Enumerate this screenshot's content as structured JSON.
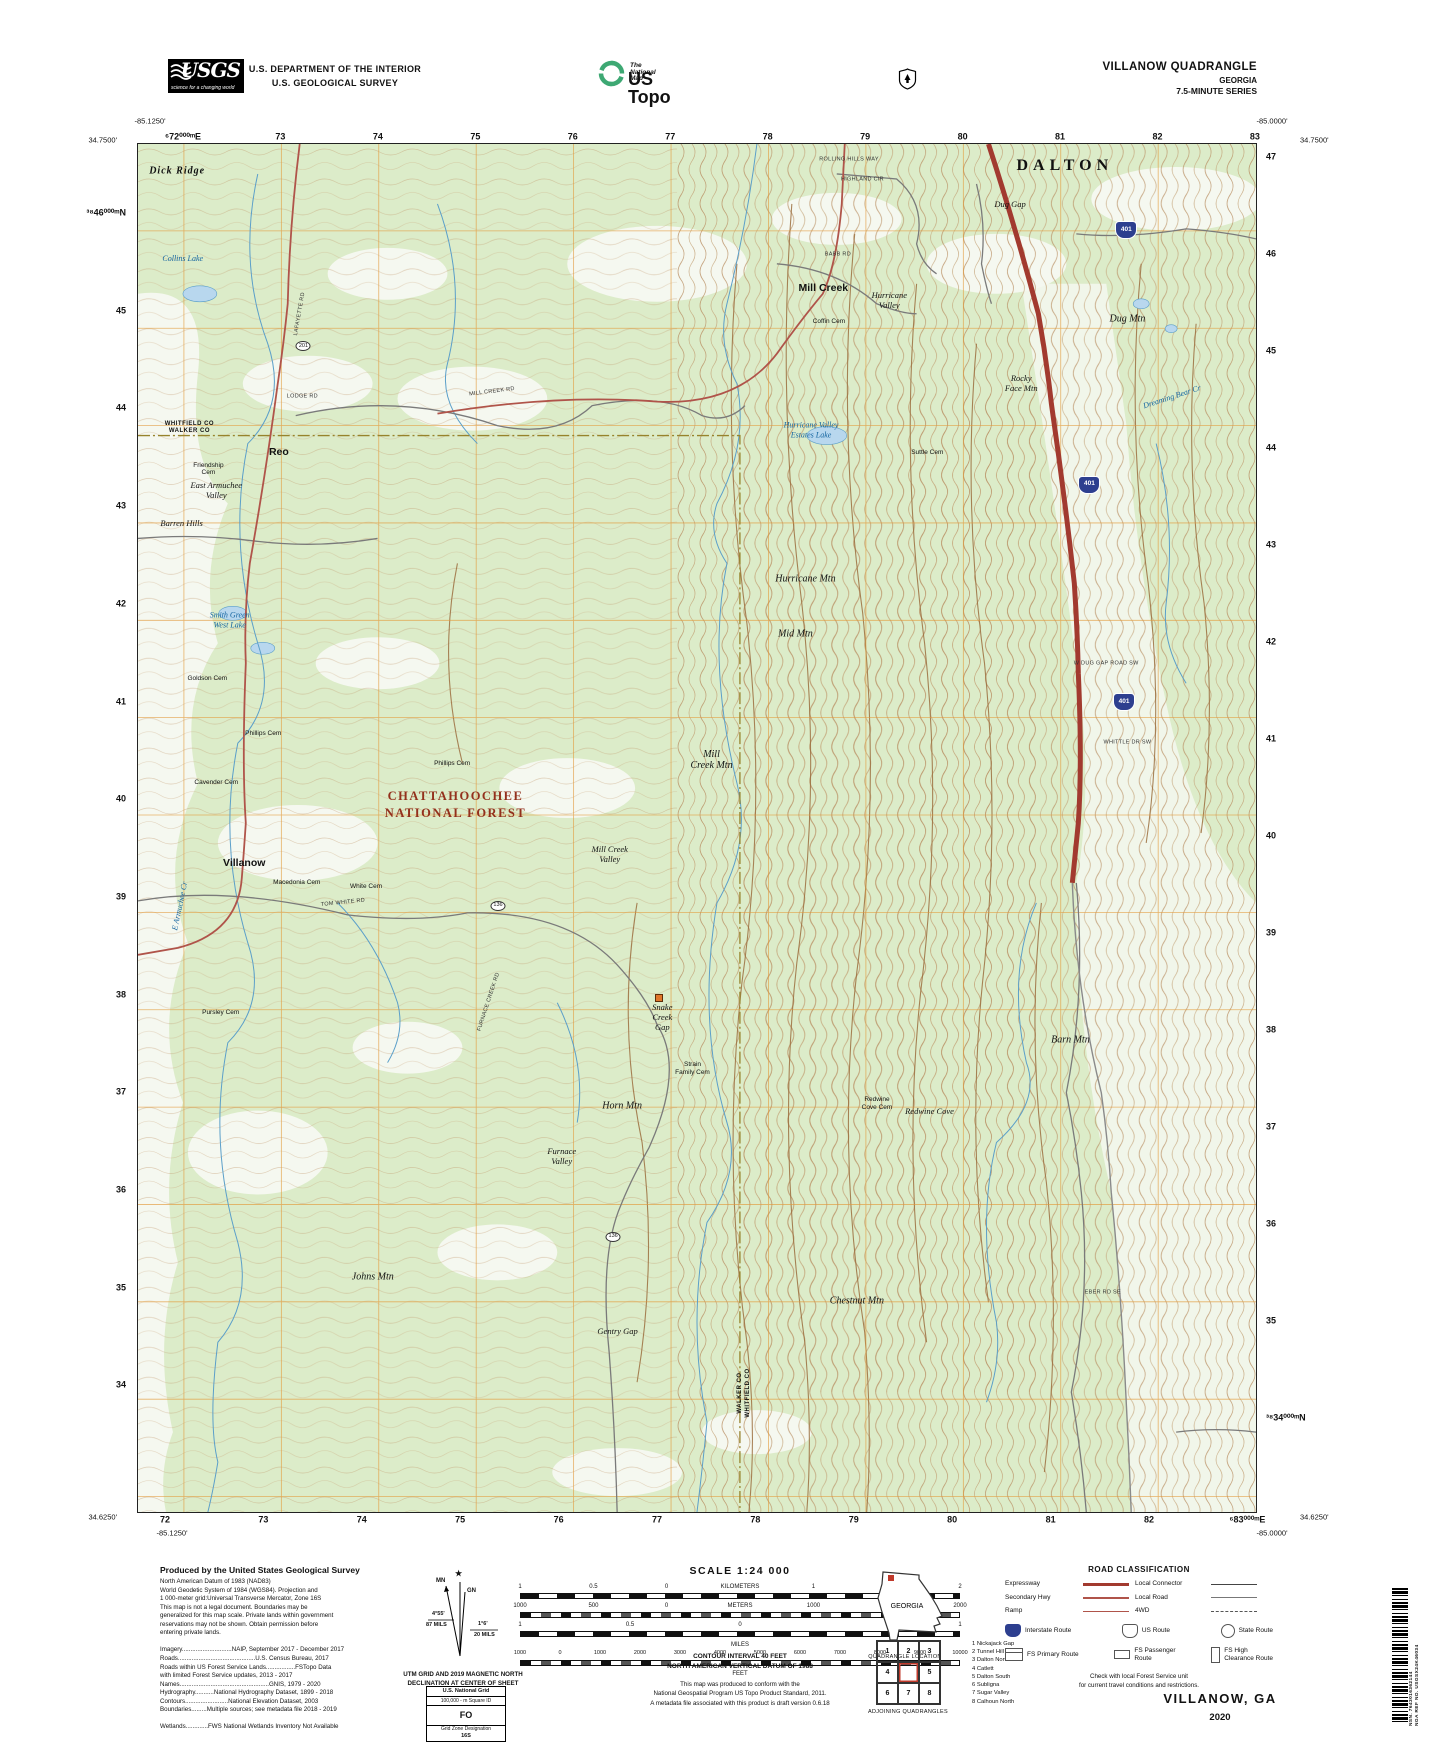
{
  "colors": {
    "map_green": "#dcecc9",
    "contour_brown": "#b98f63",
    "index_contour": "#9c6f3f",
    "water_blue": "#5b9fc9",
    "lake_fill": "#b8d7ee",
    "interstate_red": "#a23a2f",
    "secondary_red": "#b0544a",
    "grid_orange": "#e39a3b",
    "county_olive": "#97832c",
    "shield_blue": "#2d3f8f",
    "forest_label_red": "#93301c",
    "ustopo_green": "#3da873"
  },
  "header": {
    "usgs_wordmark": "USGS",
    "usgs_tagline": "science for a changing world",
    "dept_line1": "U.S. DEPARTMENT OF THE INTERIOR",
    "dept_line2": "U.S. GEOLOGICAL SURVEY",
    "ustopo_small": "The National Map",
    "ustopo_large": "US Topo",
    "quad_title": "VILLANOW QUADRANGLE",
    "quad_state": "GEORGIA",
    "quad_series": "7.5-MINUTE SERIES"
  },
  "map": {
    "corners": {
      "top_left_lon": "-85.1250'",
      "top_left_lat": "34.7500'",
      "top_right_lon": "-85.0000'",
      "top_right_lat": "34.7500'",
      "bottom_left_lat": "34.6250'",
      "bottom_left_lon": "-85.1250'",
      "bottom_right_lat": "34.6250'",
      "bottom_right_lon": "-85.0000'"
    },
    "grid": {
      "top": [
        "⁶72⁰⁰⁰ᵐE",
        "73",
        "74",
        "75",
        "76",
        "77",
        "78",
        "79",
        "80",
        "81",
        "82",
        "83"
      ],
      "bottom": [
        "72",
        "73",
        "74",
        "75",
        "76",
        "77",
        "78",
        "79",
        "80",
        "81",
        "82",
        "⁶83⁰⁰⁰ᵐE"
      ],
      "left": [
        "³⁸46⁰⁰⁰ᵐN",
        "45",
        "44",
        "43",
        "42",
        "41",
        "40",
        "39",
        "38",
        "37",
        "36",
        "35",
        "34"
      ],
      "right": [
        "47",
        "46",
        "45",
        "44",
        "43",
        "42",
        "41",
        "40",
        "39",
        "38",
        "37",
        "36",
        "35",
        "³⁸34⁰⁰⁰ᵐN"
      ]
    },
    "labels": [
      {
        "t": "Dick Ridge",
        "x": 3.5,
        "y": 2.0,
        "c": "c-ridge"
      },
      {
        "t": "DALTON",
        "x": 82.9,
        "y": 1.6,
        "c": "c-city"
      },
      {
        "t": "Mill Creek",
        "x": 61.3,
        "y": 10.6,
        "c": "c-town"
      },
      {
        "t": "Hurricane\nValley",
        "x": 67.2,
        "y": 11.4,
        "c": "c-terr2"
      },
      {
        "t": "Dug Gap",
        "x": 78.0,
        "y": 4.4,
        "c": "c-terr2"
      },
      {
        "t": "Dug Mtn",
        "x": 88.5,
        "y": 12.8,
        "c": "c-terr"
      },
      {
        "t": "Rocky\nFace Mtn",
        "x": 79.0,
        "y": 17.5,
        "c": "c-terr2"
      },
      {
        "t": "Suttle Cem",
        "x": 70.6,
        "y": 22.6,
        "c": "c-cem"
      },
      {
        "t": "WHITFIELD CO\nWALKER CO",
        "x": 4.6,
        "y": 20.8,
        "c": "c-county"
      },
      {
        "t": "Reo",
        "x": 12.6,
        "y": 22.6,
        "c": "c-town"
      },
      {
        "t": "Friendship\nCem",
        "x": 6.3,
        "y": 23.8,
        "c": "c-cem"
      },
      {
        "t": "East Armuchee\nValley",
        "x": 7.0,
        "y": 25.3,
        "c": "c-terr2"
      },
      {
        "t": "Barren Hills",
        "x": 3.9,
        "y": 27.7,
        "c": "c-terr2"
      },
      {
        "t": "Hurricane Mtn",
        "x": 59.7,
        "y": 31.8,
        "c": "c-terr"
      },
      {
        "t": "Mid Mtn",
        "x": 58.8,
        "y": 35.8,
        "c": "c-terr"
      },
      {
        "t": "Goldson Cem",
        "x": 6.2,
        "y": 39.1,
        "c": "c-cem"
      },
      {
        "t": "Phillips Cem",
        "x": 11.2,
        "y": 43.1,
        "c": "c-cem"
      },
      {
        "t": "Cavender Cem",
        "x": 7.0,
        "y": 46.7,
        "c": "c-cem"
      },
      {
        "t": "Phillips Cem",
        "x": 28.1,
        "y": 45.3,
        "c": "c-cem"
      },
      {
        "t": "CHATTAHOOCHEE\nNATIONAL FOREST",
        "x": 28.4,
        "y": 48.3,
        "c": "c-nf"
      },
      {
        "t": "Mill\nCreek Mtn",
        "x": 51.3,
        "y": 45.0,
        "c": "c-terr"
      },
      {
        "t": "Villanow",
        "x": 9.5,
        "y": 52.6,
        "c": "c-town"
      },
      {
        "t": "Macedonia Cem",
        "x": 14.2,
        "y": 54.0,
        "c": "c-cem"
      },
      {
        "t": "White Cem",
        "x": 20.4,
        "y": 54.3,
        "c": "c-cem"
      },
      {
        "t": "Mill Creek\nValley",
        "x": 42.2,
        "y": 51.9,
        "c": "c-terr2"
      },
      {
        "t": "TOM WHITE RD",
        "x": 18.3,
        "y": 55.5,
        "c": "c-road",
        "r": -6
      },
      {
        "t": "Pursley Cem",
        "x": 7.4,
        "y": 63.5,
        "c": "c-cem"
      },
      {
        "t": "Snake\nCreek\nGap",
        "x": 46.9,
        "y": 63.8,
        "c": "c-terr2"
      },
      {
        "t": "",
        "x": 46.6,
        "y": 62.4,
        "c": "c-marker"
      },
      {
        "t": "Strain\nFamily Cem",
        "x": 49.6,
        "y": 67.6,
        "c": "c-cem"
      },
      {
        "t": "Horn Mtn",
        "x": 43.3,
        "y": 70.3,
        "c": "c-terr"
      },
      {
        "t": "Redwine\nCove Cem",
        "x": 66.1,
        "y": 70.2,
        "c": "c-cem"
      },
      {
        "t": "Redwine Cove",
        "x": 70.8,
        "y": 70.7,
        "c": "c-terr2"
      },
      {
        "t": "Barn Mtn",
        "x": 83.4,
        "y": 65.5,
        "c": "c-terr"
      },
      {
        "t": "Furnace\nValley",
        "x": 37.9,
        "y": 74.0,
        "c": "c-terr2"
      },
      {
        "t": "Johns Mtn",
        "x": 21.0,
        "y": 82.8,
        "c": "c-terr"
      },
      {
        "t": "Gentry Gap",
        "x": 42.9,
        "y": 86.8,
        "c": "c-terr2"
      },
      {
        "t": "Chestnut Mtn",
        "x": 64.3,
        "y": 84.6,
        "c": "c-terr"
      },
      {
        "t": "WALKER CO\nWHITFIELD CO",
        "x": 54.3,
        "y": 91.3,
        "c": "c-county",
        "r": -90
      },
      {
        "t": "LAFAYETTE RD",
        "x": 14.5,
        "y": 12.4,
        "c": "c-road",
        "r": -80
      },
      {
        "t": "MILL CREEK RD",
        "x": 31.7,
        "y": 18.1,
        "c": "c-road",
        "r": -7
      },
      {
        "t": "LODGE RD",
        "x": 14.7,
        "y": 18.5,
        "c": "c-road"
      },
      {
        "t": "BABB RD",
        "x": 62.6,
        "y": 8.1,
        "c": "c-road"
      },
      {
        "t": "ROLLING HILLS WAY",
        "x": 63.6,
        "y": 1.2,
        "c": "c-road"
      },
      {
        "t": "HIGHLAND CIR",
        "x": 64.8,
        "y": 2.6,
        "c": "c-road"
      },
      {
        "t": "W DUG GAP ROAD SW",
        "x": 86.6,
        "y": 38.0,
        "c": "c-road"
      },
      {
        "t": "WHITTLE DR SW",
        "x": 88.5,
        "y": 43.8,
        "c": "c-road"
      },
      {
        "t": "EBER RD SE",
        "x": 86.3,
        "y": 84.0,
        "c": "c-road"
      },
      {
        "t": "FURNACE CREEK RD",
        "x": 31.4,
        "y": 62.7,
        "c": "c-road",
        "r": -72
      },
      {
        "t": "Coffin Cem",
        "x": 61.8,
        "y": 13.0,
        "c": "c-cem"
      },
      {
        "t": "E Armuchee Cr",
        "x": 3.8,
        "y": 55.7,
        "c": "c-water",
        "r": -78
      },
      {
        "t": "Dreaming Bear Cr",
        "x": 92.5,
        "y": 18.5,
        "c": "c-water",
        "r": -18
      },
      {
        "t": "Collins Lake",
        "x": 4.0,
        "y": 8.4,
        "c": "c-water"
      },
      {
        "t": "Smith Green\nWest Lake",
        "x": 8.2,
        "y": 34.8,
        "c": "c-water"
      },
      {
        "t": "Hurricane Valley\nEstates Lake",
        "x": 60.2,
        "y": 20.9,
        "c": "c-water"
      }
    ],
    "shields": [
      {
        "n": "401",
        "x": 88.4,
        "y": 6.3
      },
      {
        "n": "401",
        "x": 85.1,
        "y": 24.9
      },
      {
        "n": "401",
        "x": 88.2,
        "y": 40.8
      }
    ],
    "route_ovals": [
      {
        "n": "201",
        "x": 14.8,
        "y": 14.8
      },
      {
        "n": "136",
        "x": 32.2,
        "y": 55.7
      },
      {
        "n": "136",
        "x": 42.5,
        "y": 79.9
      }
    ]
  },
  "footer": {
    "credits_title": "Produced by the United States Geological Survey",
    "credits_lines": [
      "North American Datum of 1983 (NAD83)",
      "World Geodetic System of 1984 (WGS84).  Projection and",
      "1 000-meter grid:Universal Transverse Mercator, Zone 16S",
      "This map is not a legal document. Boundaries may be",
      "generalized for this map scale. Private lands within government",
      "reservations may not be shown. Obtain permission before",
      "entering private lands.",
      "",
      "Imagery.............................NAIP, September 2017 - December 2017",
      "Roads.............................................U.S. Census Bureau, 2017",
      "Roads within US Forest Service Lands.................FSTopo Data",
      "            with limited Forest Service updates, 2013 - 2017",
      "Names....................................................GNIS, 1979 - 2020",
      "Hydrography...........National Hydrography Dataset, 1899 - 2018",
      "Contours.........................National Elevation Dataset, 2003",
      "Boundaries.........Multiple sources; see metadata file 2018 - 2019",
      "",
      "Wetlands.............FWS National Wetlands Inventory Not Available"
    ],
    "declination": {
      "star": "★",
      "mn": "MN",
      "gn": "GN",
      "mn_deg": "4°55'",
      "mn_mils": "87 MILS",
      "gn_deg": "1°6'",
      "gn_mils": "20 MILS",
      "caption1": "UTM GRID AND 2019 MAGNETIC NORTH",
      "caption2": "DECLINATION AT CENTER OF SHEET"
    },
    "usng": {
      "title": "U.S. National Grid",
      "sub": "100,000 - m Square ID",
      "square": "FO",
      "zone_label": "Grid Zone Designation",
      "zone": "16S"
    },
    "scale": {
      "title": "SCALE 1:24 000",
      "km_labels": [
        "1",
        "0.5",
        "0",
        "KILOMETERS",
        "1",
        "2"
      ],
      "m_labels": [
        "1000",
        "500",
        "0",
        "METERS",
        "1000",
        "2000"
      ],
      "mi_labels": [
        "1",
        "0.5",
        "0",
        "1"
      ],
      "mi_word": "MILES",
      "ft_labels": [
        "1000",
        "0",
        "1000",
        "2000",
        "3000",
        "4000",
        "5000",
        "6000",
        "7000",
        "8000",
        "9000",
        "10000"
      ],
      "ft_word": "FEET"
    },
    "contour_note1": "CONTOUR INTERVAL 40 FEET",
    "contour_note2": "NORTH AMERICAN VERTICAL DATUM OF 1988",
    "conform_lines": [
      "This map was produced to conform with the",
      "National Geospatial Program US Topo Product Standard, 2011.",
      "A metadata file associated with this product is draft version 0.6.18"
    ],
    "location": {
      "state": "GEORGIA",
      "caption": "QUADRANGLE LOCATION"
    },
    "adjoining": {
      "caption": "ADJOINING QUADRANGLES",
      "cells": [
        "1",
        "2",
        "3",
        "4",
        "",
        "5",
        "6",
        "7",
        "8"
      ],
      "list": [
        "1 Nickajack Gap",
        "2 Tunnel Hill",
        "3 Dalton North",
        "4 Catlett",
        "5 Dalton South",
        "6 Subligna",
        "7 Sugar Valley",
        "8 Calhoun North"
      ]
    },
    "roadclass": {
      "title": "ROAD CLASSIFICATION",
      "rows": [
        {
          "label": "Expressway",
          "style": "expressway"
        },
        {
          "label": "Secondary Hwy",
          "style": "secondary"
        },
        {
          "label": "Ramp",
          "style": "ramp"
        },
        {
          "label": "Local Connector",
          "style": "connector"
        },
        {
          "label": "Local Road",
          "style": "local"
        },
        {
          "label": "4WD",
          "style": "fourwd"
        }
      ],
      "shields": [
        {
          "label": "Interstate Route",
          "type": "interstate"
        },
        {
          "label": "US Route",
          "type": "us"
        },
        {
          "label": "State Route",
          "type": "state"
        }
      ],
      "fs": [
        {
          "label": "FS Primary Route",
          "type": "fsp"
        },
        {
          "label": "FS Passenger\nRoute",
          "type": "fspass"
        },
        {
          "label": "FS High\nClearance Route",
          "type": "fshigh"
        }
      ],
      "note1": "Check with local Forest Service unit",
      "note2": "for current travel conditions and restrictions."
    },
    "sheet_name": "VILLANOW,  GA",
    "sheet_year": "2020",
    "barcode_nsn": "NSN. 7643016362144",
    "barcode_nga": "NGA REF NO. USGSX24K46034"
  }
}
